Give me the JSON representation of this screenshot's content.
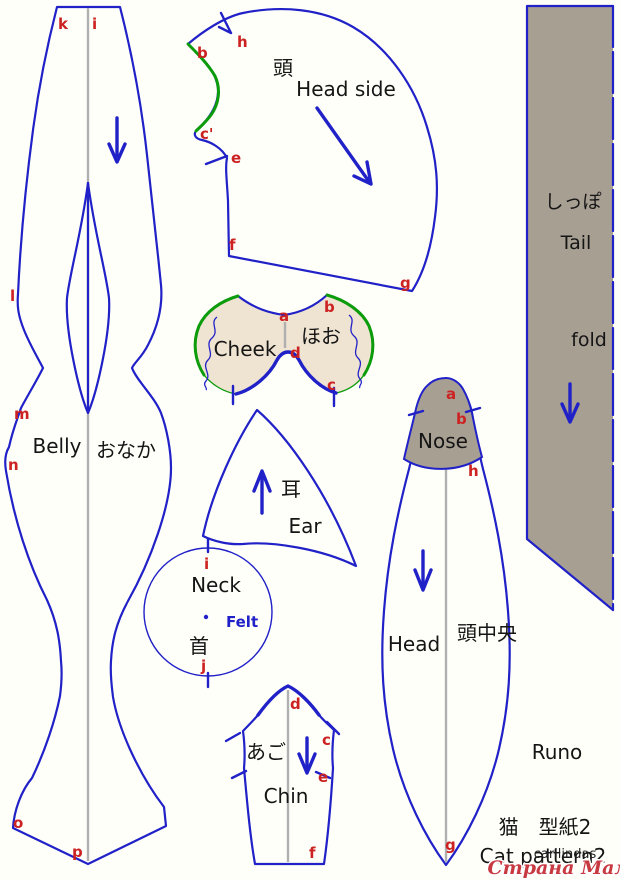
{
  "colors": {
    "outline_blue": "#2121c8",
    "seam_green": "#0b9b0b",
    "point_label_red": "#cc2222",
    "fabric_beige": "#efe3d1",
    "fabric_gray": "#a89f93"
  },
  "pieces": {
    "belly": {
      "label_en": "Belly",
      "label_ja": "おなか",
      "points": [
        "k",
        "i",
        "l",
        "m",
        "n",
        "o",
        "p"
      ]
    },
    "head_side": {
      "label_en": "Head side",
      "label_ja": "頭",
      "points": [
        "b",
        "h",
        "c'",
        "e",
        "f",
        "g"
      ]
    },
    "tail": {
      "label_en": "Tail",
      "label_ja": "しっぽ",
      "fold_note": "fold"
    },
    "cheek": {
      "label_en": "Cheek",
      "label_ja": "ほお",
      "points": [
        "a",
        "b",
        "d",
        "c"
      ]
    },
    "ear": {
      "label_en": "Ear",
      "label_ja": "耳"
    },
    "neck": {
      "label_en": "Neck",
      "label_ja": "首",
      "material_note": "Felt",
      "points": [
        "i",
        "j"
      ]
    },
    "nose": {
      "label_en": "Nose",
      "points": [
        "a",
        "b",
        "h"
      ]
    },
    "head_center": {
      "label_en": "Head",
      "label_ja": "頭中央",
      "points": [
        "g"
      ]
    },
    "chin": {
      "label_en": "Chin",
      "label_ja": "あご",
      "points": [
        "d",
        "c",
        "e",
        "f"
      ]
    }
  },
  "footer": {
    "author": "Runo",
    "title_ja": "猫　型紙2",
    "title_en": "Cat pattern2",
    "watermark_name": "carilindas",
    "watermark_site": "Страна Мам"
  }
}
